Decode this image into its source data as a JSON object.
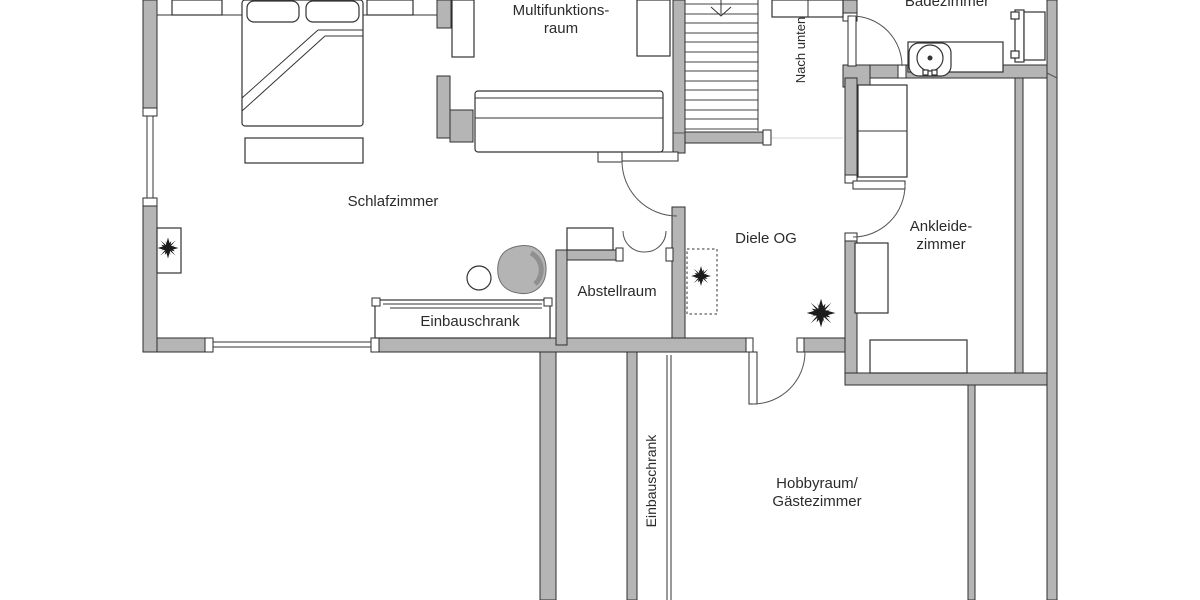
{
  "floorplan": {
    "labels": {
      "multifunktionsraum_1": "Multifunktions-",
      "multifunktionsraum_2": "raum",
      "schlafzimmer": "Schlafzimmer",
      "badezimmer": "Badezimmer",
      "nach_unten": "Nach unten",
      "diele_og": "Diele OG",
      "ankleide_1": "Ankleide-",
      "ankleide_2": "zimmer",
      "abstellraum": "Abstellraum",
      "einbauschrank_schlafzimmer": "Einbauschrank",
      "einbauschrank_hobbyraum": "Einbauschrank",
      "hobbyraum_1": "Hobbyraum/",
      "hobbyraum_2": "Gästezimmer"
    },
    "symbols": [
      "plant-icon",
      "stairs-down-arrow-icon",
      "double-swing-door-icon",
      "washbasin-icon"
    ],
    "colors": {
      "background": "#ffffff",
      "wall_fill": "#b5b5b5",
      "wall_stroke": "#2e2e2e",
      "line": "#333333",
      "beanbag_fill": "#b4b4b4"
    }
  }
}
